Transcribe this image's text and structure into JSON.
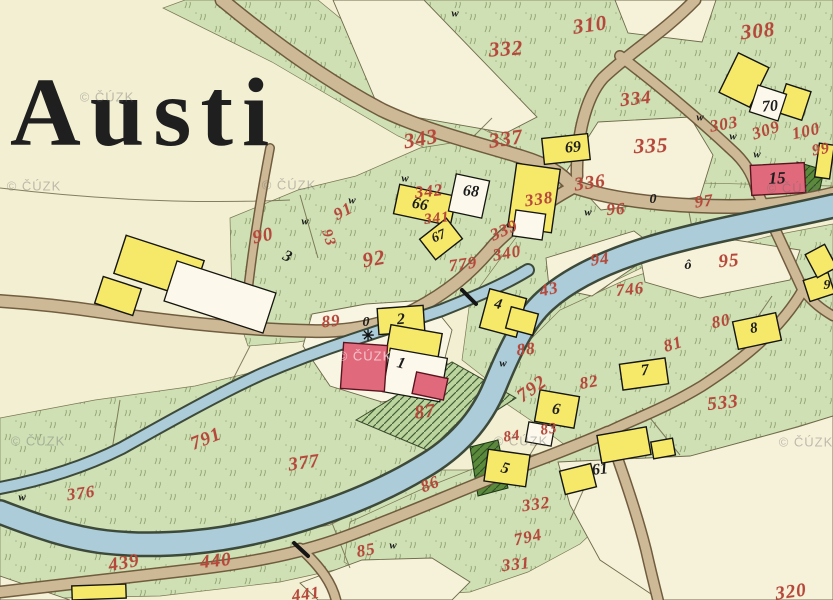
{
  "map": {
    "title_label": "Austi",
    "watermark_text": "© ČÚZK",
    "colors": {
      "paper": "#f3efd3",
      "field": "#f7f3dd",
      "meadow": "#cfe0b5",
      "water": "#abccd8",
      "road": "#cdb996",
      "building_wood": "#f6e96a",
      "building_masonry": "#e06a7c",
      "building_other": "#fcf9ec",
      "parcel_number": "#b5483a",
      "house_number": "#1c1c1c"
    },
    "labels": {
      "parcels": [
        {
          "t": "310",
          "x": 590,
          "y": 25,
          "r": -8,
          "s": 21
        },
        {
          "t": "332",
          "x": 506,
          "y": 49,
          "r": -4,
          "s": 21
        },
        {
          "t": "308",
          "x": 758,
          "y": 31,
          "r": -6,
          "s": 21
        },
        {
          "t": "334",
          "x": 636,
          "y": 99,
          "r": -6,
          "s": 19
        },
        {
          "t": "303",
          "x": 724,
          "y": 124,
          "r": -10,
          "s": 17
        },
        {
          "t": "309",
          "x": 766,
          "y": 130,
          "r": -18,
          "s": 17
        },
        {
          "t": "100",
          "x": 806,
          "y": 131,
          "r": -12,
          "s": 17
        },
        {
          "t": "99",
          "x": 821,
          "y": 150,
          "r": -10,
          "s": 16
        },
        {
          "t": "343",
          "x": 421,
          "y": 139,
          "r": -10,
          "s": 21
        },
        {
          "t": "337",
          "x": 506,
          "y": 139,
          "r": -8,
          "s": 21
        },
        {
          "t": "335",
          "x": 651,
          "y": 146,
          "r": -2,
          "s": 21
        },
        {
          "t": "336",
          "x": 590,
          "y": 183,
          "r": -8,
          "s": 19
        },
        {
          "t": "338",
          "x": 539,
          "y": 199,
          "r": -8,
          "s": 17
        },
        {
          "t": "342",
          "x": 429,
          "y": 191,
          "r": -6,
          "s": 17
        },
        {
          "t": "341",
          "x": 437,
          "y": 219,
          "r": -6,
          "s": 15
        },
        {
          "t": "339",
          "x": 504,
          "y": 230,
          "r": -24,
          "s": 17
        },
        {
          "t": "340",
          "x": 507,
          "y": 253,
          "r": -10,
          "s": 17
        },
        {
          "t": "779",
          "x": 463,
          "y": 264,
          "r": -8,
          "s": 17
        },
        {
          "t": "90",
          "x": 263,
          "y": 236,
          "r": -12,
          "s": 19
        },
        {
          "t": "91",
          "x": 343,
          "y": 211,
          "r": -28,
          "s": 17
        },
        {
          "t": "93",
          "x": 328,
          "y": 238,
          "r": 72,
          "s": 15
        },
        {
          "t": "92",
          "x": 374,
          "y": 259,
          "r": -10,
          "s": 21
        },
        {
          "t": "96",
          "x": 616,
          "y": 209,
          "r": -4,
          "s": 17
        },
        {
          "t": "97",
          "x": 704,
          "y": 201,
          "r": -8,
          "s": 17
        },
        {
          "t": "94",
          "x": 600,
          "y": 259,
          "r": -8,
          "s": 17
        },
        {
          "t": "95",
          "x": 729,
          "y": 261,
          "r": -4,
          "s": 19
        },
        {
          "t": "43",
          "x": 549,
          "y": 289,
          "r": -12,
          "s": 17
        },
        {
          "t": "746",
          "x": 630,
          "y": 289,
          "r": -6,
          "s": 17
        },
        {
          "t": "89",
          "x": 331,
          "y": 321,
          "r": -6,
          "s": 17
        },
        {
          "t": "88",
          "x": 526,
          "y": 349,
          "r": -6,
          "s": 17
        },
        {
          "t": "87",
          "x": 425,
          "y": 412,
          "r": -8,
          "s": 19
        },
        {
          "t": "792",
          "x": 532,
          "y": 389,
          "r": -36,
          "s": 19
        },
        {
          "t": "80",
          "x": 721,
          "y": 321,
          "r": -12,
          "s": 17
        },
        {
          "t": "81",
          "x": 673,
          "y": 344,
          "r": -18,
          "s": 17
        },
        {
          "t": "82",
          "x": 589,
          "y": 382,
          "r": -10,
          "s": 17
        },
        {
          "t": "83",
          "x": 549,
          "y": 430,
          "r": -10,
          "s": 15
        },
        {
          "t": "84",
          "x": 512,
          "y": 437,
          "r": -8,
          "s": 15
        },
        {
          "t": "533",
          "x": 723,
          "y": 403,
          "r": -6,
          "s": 19
        },
        {
          "t": "86",
          "x": 430,
          "y": 484,
          "r": -22,
          "s": 17
        },
        {
          "t": "85",
          "x": 366,
          "y": 550,
          "r": -10,
          "s": 17
        },
        {
          "t": "791",
          "x": 206,
          "y": 439,
          "r": -22,
          "s": 19
        },
        {
          "t": "376",
          "x": 81,
          "y": 493,
          "r": -8,
          "s": 17
        },
        {
          "t": "377",
          "x": 304,
          "y": 463,
          "r": -8,
          "s": 19
        },
        {
          "t": "439",
          "x": 124,
          "y": 563,
          "r": -10,
          "s": 19
        },
        {
          "t": "440",
          "x": 216,
          "y": 561,
          "r": -6,
          "s": 19
        },
        {
          "t": "441",
          "x": 306,
          "y": 594,
          "r": -8,
          "s": 17
        },
        {
          "t": "332",
          "x": 536,
          "y": 504,
          "r": -8,
          "s": 17
        },
        {
          "t": "794",
          "x": 528,
          "y": 537,
          "r": -12,
          "s": 17
        },
        {
          "t": "331",
          "x": 516,
          "y": 564,
          "r": -6,
          "s": 17
        },
        {
          "t": "320",
          "x": 791,
          "y": 592,
          "r": -8,
          "s": 19
        }
      ],
      "houses": [
        {
          "t": "70",
          "x": 770,
          "y": 107,
          "r": -5,
          "s": 16
        },
        {
          "t": "69",
          "x": 573,
          "y": 148,
          "r": -5,
          "s": 16
        },
        {
          "t": "15",
          "x": 777,
          "y": 178,
          "r": -2,
          "s": 17
        },
        {
          "t": "68",
          "x": 471,
          "y": 192,
          "r": 5,
          "s": 16
        },
        {
          "t": "66",
          "x": 420,
          "y": 205,
          "r": 10,
          "s": 16
        },
        {
          "t": "67",
          "x": 439,
          "y": 237,
          "r": -24,
          "s": 14
        },
        {
          "t": "3",
          "x": 287,
          "y": 257,
          "r": 24,
          "s": 16
        },
        {
          "t": "2",
          "x": 401,
          "y": 320,
          "r": -4,
          "s": 16
        },
        {
          "t": "1",
          "x": 401,
          "y": 364,
          "r": 14,
          "s": 16
        },
        {
          "t": "0",
          "x": 366,
          "y": 323,
          "r": 0,
          "s": 14
        },
        {
          "t": "0",
          "x": 653,
          "y": 200,
          "r": 0,
          "s": 14
        },
        {
          "t": "ô",
          "x": 688,
          "y": 266,
          "r": 0,
          "s": 14
        },
        {
          "t": "4",
          "x": 498,
          "y": 305,
          "r": 12,
          "s": 15
        },
        {
          "t": "7",
          "x": 645,
          "y": 371,
          "r": -8,
          "s": 16
        },
        {
          "t": "6",
          "x": 556,
          "y": 410,
          "r": 8,
          "s": 16
        },
        {
          "t": "5",
          "x": 505,
          "y": 469,
          "r": 16,
          "s": 16
        },
        {
          "t": "61",
          "x": 600,
          "y": 470,
          "r": -6,
          "s": 16
        },
        {
          "t": "8",
          "x": 754,
          "y": 329,
          "r": -10,
          "s": 15
        },
        {
          "t": "9",
          "x": 827,
          "y": 286,
          "r": 0,
          "s": 14
        }
      ]
    },
    "symbols": {
      "meadow_mark_glyph": "w",
      "chapel_glyph": "✳",
      "chapel": {
        "x": 368,
        "y": 337
      },
      "meadow_marks": [
        {
          "x": 455,
          "y": 14
        },
        {
          "x": 405,
          "y": 179
        },
        {
          "x": 305,
          "y": 222
        },
        {
          "x": 352,
          "y": 201
        },
        {
          "x": 700,
          "y": 118
        },
        {
          "x": 733,
          "y": 137
        },
        {
          "x": 757,
          "y": 155
        },
        {
          "x": 588,
          "y": 213
        },
        {
          "x": 503,
          "y": 364
        },
        {
          "x": 393,
          "y": 546
        },
        {
          "x": 22,
          "y": 498
        }
      ]
    },
    "watermarks": [
      {
        "x": 107,
        "y": 97
      },
      {
        "x": 34,
        "y": 186
      },
      {
        "x": 289,
        "y": 185
      },
      {
        "x": 365,
        "y": 356,
        "light": true
      },
      {
        "x": 521,
        "y": 441
      },
      {
        "x": 38,
        "y": 441
      },
      {
        "x": 794,
        "y": 188
      },
      {
        "x": 806,
        "y": 442
      }
    ]
  }
}
